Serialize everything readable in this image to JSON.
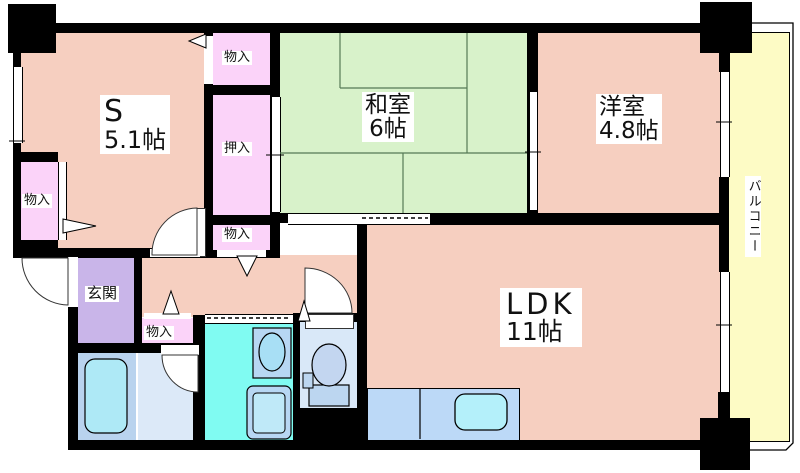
{
  "plan_title": "apartment-floor-plan",
  "rooms": {
    "service_room": {
      "label": "S",
      "size": "5.1帖"
    },
    "japanese_room": {
      "label": "和室",
      "size": "6帖"
    },
    "western_room": {
      "label": "洋室",
      "size": "4.8帖"
    },
    "ldk": {
      "label": "LDK",
      "size": "11帖"
    },
    "entrance": {
      "label": "玄関"
    },
    "balcony": {
      "label": "バルコニー"
    }
  },
  "closets": {
    "storage": "物入",
    "futon_closet": "押入"
  },
  "fixtures": [
    "bathtub",
    "washbasin",
    "washing-machine",
    "toilet",
    "kitchen-sink",
    "door-swing-arc",
    "sliding-door",
    "window"
  ],
  "colors": {
    "wall": "#000000",
    "room_pink": "#F6CFC0",
    "tatami_green": "#D8F2CA",
    "closet_pink": "#FBD3F9",
    "entrance_purple": "#C9B5E9",
    "balcony_yellow": "#FDFBC5",
    "bath_blue": "#B9D3EE",
    "tub_cyan": "#AEE9F6",
    "powder_blue": "#DCE9F8",
    "washroom_cyan": "#80FBF2",
    "toilet_blue": "#D9E8F8",
    "counter_blue": "#BCD9F7",
    "sink_cyan": "#B4F0FA"
  }
}
